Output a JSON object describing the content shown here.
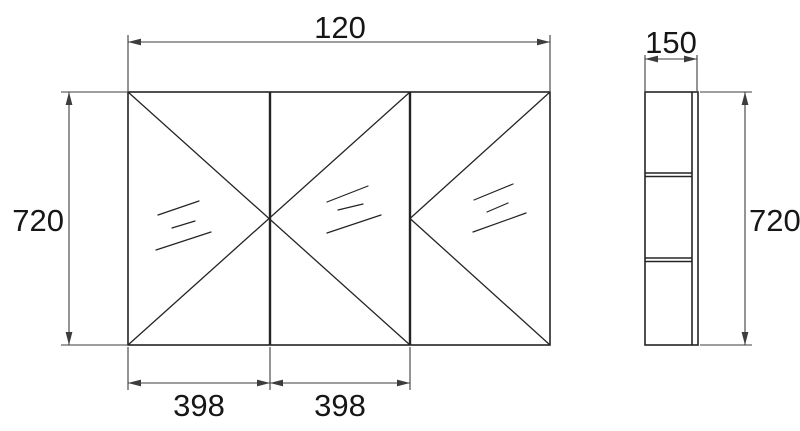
{
  "colors": {
    "background": "#ffffff",
    "object_line": "#242424",
    "dimension_line": "#3d3d3d",
    "text": "#161616"
  },
  "front_view": {
    "overall_width_label": "120",
    "height_label": "720",
    "door_width_labels": [
      "398",
      "398"
    ],
    "door_count": 3
  },
  "side_view": {
    "depth_label": "150",
    "height_label": "720"
  }
}
